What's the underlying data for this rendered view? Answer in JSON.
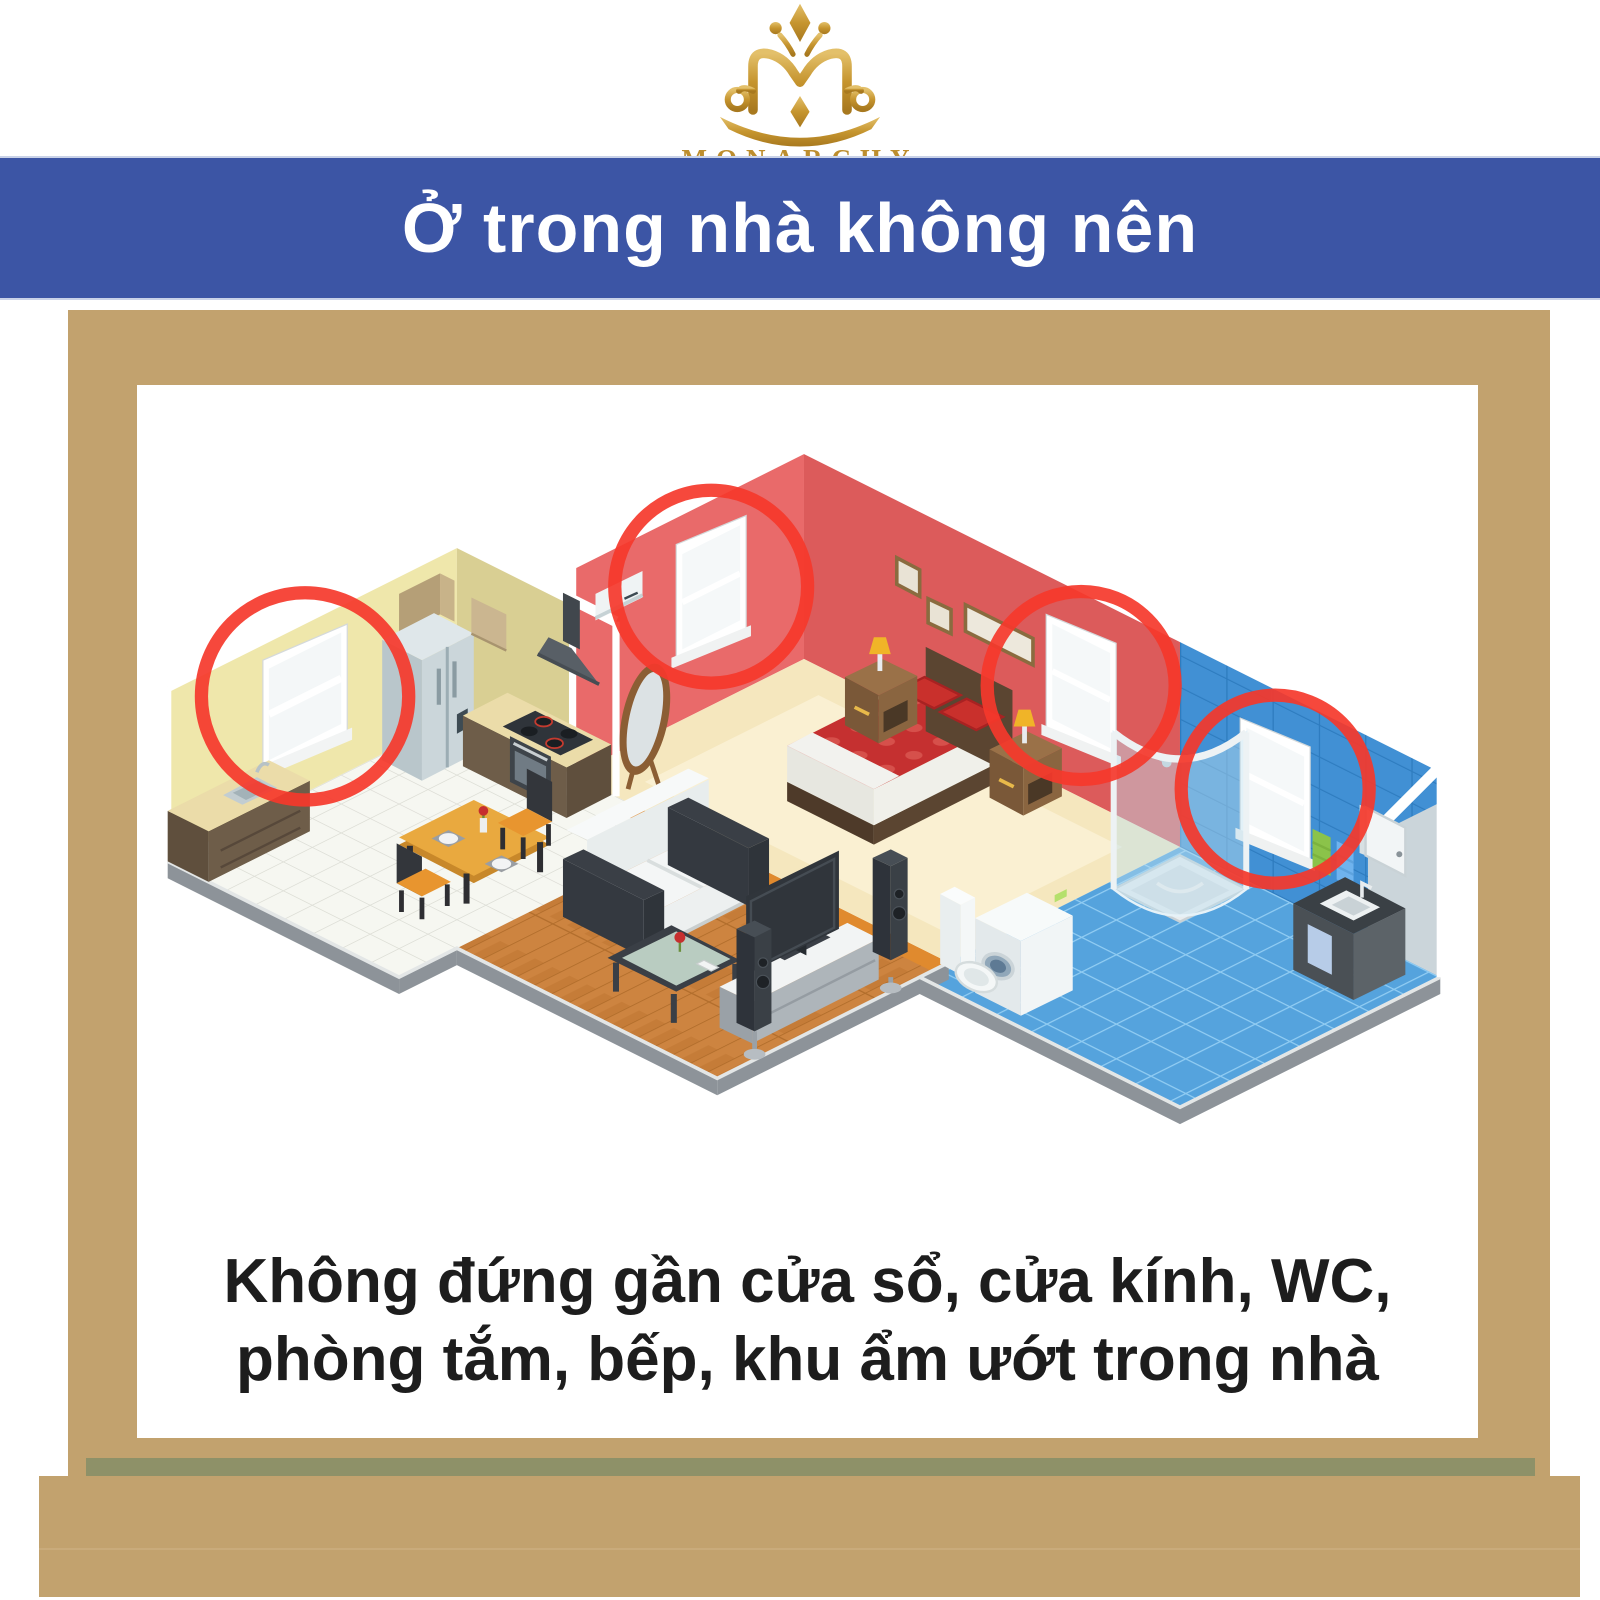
{
  "logo": {
    "wordmark": "MONARCHY",
    "gold": "#BD8E2E"
  },
  "banner": {
    "title": "Ở trong nhà không nên",
    "background": "#3C55A5",
    "text_color": "#FFFFFF"
  },
  "easel": {
    "wood_color": "#C2A26E",
    "shadow_color": "#8E9168"
  },
  "illustration": {
    "type": "isometric-apartment-cutaway",
    "rooms": [
      {
        "name": "kitchen",
        "wall_color": "#EFE7AB",
        "floor": "white-tile"
      },
      {
        "name": "bedroom",
        "wall_color": "#E96A6A",
        "floor": "cream"
      },
      {
        "name": "bathroom",
        "wall_color": "#4190D4",
        "floor": "blue-tile"
      },
      {
        "name": "living-room",
        "floor": "wood-parquet"
      }
    ],
    "highlights": {
      "color": "#F5382B",
      "count": 4,
      "targets": [
        "kitchen-window",
        "bedroom-left-window",
        "bedroom-right-window",
        "bathroom-window"
      ]
    }
  },
  "caption": {
    "lines": [
      "Không đứng gần cửa sổ, cửa kính, WC,",
      "phòng tắm, bếp, khu ẩm ướt trong nhà"
    ],
    "color": "#1D1D1D"
  }
}
